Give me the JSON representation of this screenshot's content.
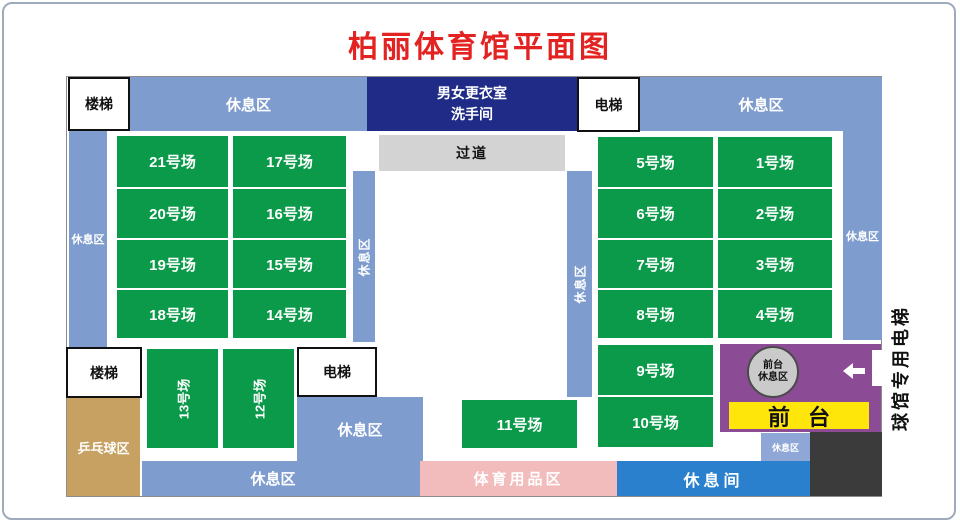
{
  "title": "柏丽体育馆平面图",
  "rooms": {
    "stairs_top": "楼梯",
    "stairs_bottom": "楼梯",
    "elevator_top": "电梯",
    "elevator_bottom": "电梯",
    "changing_room_line1": "男女更衣室",
    "changing_room_line2": "洗手间",
    "corridor": "过道"
  },
  "zones": {
    "rest_top_left": "休息区",
    "rest_top_right": "休息区",
    "rest_left_strip": "休息区",
    "rest_right_strip": "休息区",
    "rest_mid_left_strip": "休息区",
    "rest_mid_right_strip": "休息区",
    "rest_bottom_center": "休息区",
    "rest_bottom_bar": "休息区",
    "rest_small_box": "休息区",
    "pingpong": "乒乓球区",
    "sports_goods": "体育用品区",
    "lounge": "休息间",
    "building_elevator": "球馆专用电梯"
  },
  "front_desk": {
    "circle_line1": "前台",
    "circle_line2": "休息区",
    "banner": "前台"
  },
  "courts": {
    "left": [
      "21号场",
      "17号场",
      "20号场",
      "16号场",
      "19号场",
      "15号场",
      "18号场",
      "14号场"
    ],
    "right": [
      "5号场",
      "1号场",
      "6号场",
      "2号场",
      "7号场",
      "3号场",
      "8号场",
      "4号场",
      "9号场",
      "10号场"
    ],
    "bottom": [
      "13号场",
      "12号场",
      "11号场"
    ]
  },
  "icons": {
    "entrance_arrow": "left-arrow"
  },
  "colors": {
    "title_red": "#E32222",
    "rest_blue": "#7E9CCE",
    "court_green": "#0A9A4A",
    "changing_navy": "#1F2B87",
    "corridor_gray": "#D3D3D3",
    "pingpong_tan": "#C7A161",
    "goods_pink": "#F2BBBC",
    "lounge_blue": "#2A80CC",
    "front_desk_purple": "#8C4B95",
    "banner_yellow": "#FFE60A",
    "dark_block": "#3B3B3B"
  }
}
